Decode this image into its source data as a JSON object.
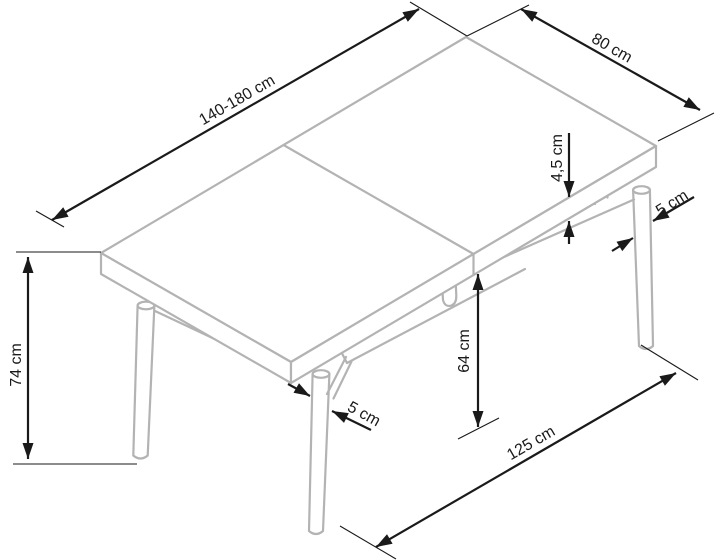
{
  "diagram": {
    "title": "extendable-dining-table-dimension-drawing",
    "subject": "rectangular extendable table with round tapered legs, isometric line drawing",
    "colors": {
      "table_line_art": "#b3b3b3",
      "dimension_lines": "#1a1a1a",
      "background": "#ffffff"
    },
    "dimensions": [
      {
        "id": "length",
        "target": "table top length (extendable range)",
        "label": "140-180 cm"
      },
      {
        "id": "width",
        "target": "table top width",
        "label": "80 cm"
      },
      {
        "id": "top_thickness",
        "target": "table top thickness",
        "label": "4,5 cm"
      },
      {
        "id": "leg_diameter_rear",
        "target": "right rear leg diameter",
        "label": "5 cm"
      },
      {
        "id": "height",
        "target": "total table height",
        "label": "74 cm"
      },
      {
        "id": "clearance",
        "target": "clearance under apron",
        "label": "64 cm"
      },
      {
        "id": "leg_diameter_front",
        "target": "front left leg diameter",
        "label": "5 cm"
      },
      {
        "id": "leg_span",
        "target": "distance between leg feet",
        "label": "125 cm"
      }
    ]
  }
}
